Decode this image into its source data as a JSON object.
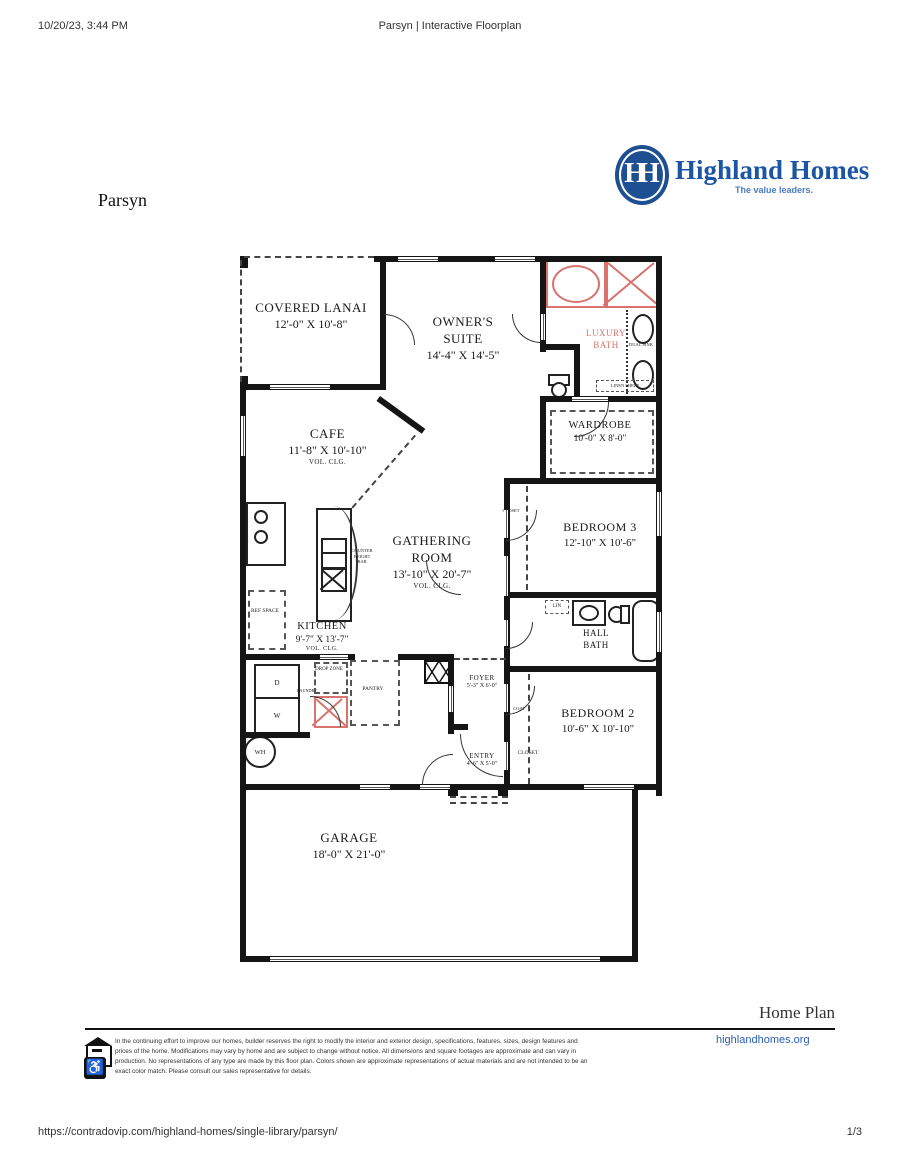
{
  "header": {
    "datetime": "10/20/23, 3:44 PM",
    "title": "Parsyn | Interactive Floorplan"
  },
  "brand": {
    "monogram": "HH",
    "name": "Highland Homes",
    "tagline": "The value leaders.",
    "blue": "#1d4f91",
    "red": "#d9736d"
  },
  "plan": {
    "name": "Parsyn",
    "rooms": {
      "lanai": {
        "name": "COVERED LANAI",
        "dims": "12'-0\" X 10'-8\""
      },
      "suite": {
        "name": "OWNER'S SUITE",
        "dims": "14'-4\" X 14'-5\""
      },
      "luxury_bath section": {
        "name": "LUXURY BATH"
      },
      "luxury_bath": {
        "name": "LUXURY BATH"
      },
      "wardrobe": {
        "name": "WARDROBE",
        "dims": "10'-0\" X 8'-0\""
      },
      "cafe": {
        "name": "CAFE",
        "dims": "11'-8\" X 10'-10\"",
        "note": "VOL. CLG."
      },
      "gathering": {
        "name": "GATHERING ROOM",
        "dims": "13'-10\" X 20'-7\"",
        "note": "VOL. CLG."
      },
      "bedroom3": {
        "name": "BEDROOM 3",
        "dims": "12'-10\" X 10'-6\""
      },
      "kitchen": {
        "name": "KITCHEN",
        "dims": "9'-7\" X 13'-7\"",
        "note": "VOL. CLG."
      },
      "hall_bath": {
        "name": "HALL BATH"
      },
      "foyer": {
        "name": "FOYER",
        "dims": "5'-3\" X 6'-0\""
      },
      "bedroom2": {
        "name": "BEDROOM 2",
        "dims": "10'-6\" X 10'-10\""
      },
      "entry": {
        "name": "ENTRY",
        "dims": "4'-6\" X 5'-0\""
      },
      "garage": {
        "name": "GARAGE",
        "dims": "18'-0\" X 21'-0\""
      }
    },
    "labels": {
      "closet": "CLOSET",
      "coat": "COAT",
      "pantry": "PANTRY",
      "drop_zone": "DROP ZONE",
      "laundry": "LAUNDRY",
      "ref_space": "REF SPACE",
      "counter_bar": "COUNTER HEIGHT BAR",
      "dual_sink": "DUAL SINK",
      "linen_shelf": "LINEN SHELF",
      "lin": "LIN",
      "dryer": "D",
      "washer": "W",
      "water_heater": "WH"
    }
  },
  "bottom": {
    "section_title": "Home Plan",
    "disclaimer": "In the continuing effort to improve our homes, builder reserves the right to modify the interior and exterior design, specifications, features, sizes, design features and prices of the home. Modifications may vary by home and are subject to change without notice. All dimensions and square footages are approximate and can vary in production. No representations of any type are made by this floor plan. Colors shown are approximate representations of actual materials and are not intended to be an exact color match. Please consult our sales representative for details.",
    "link": "highlandhomes.org"
  },
  "footer": {
    "url": "https://contradovip.com/highland-homes/single-library/parsyn/",
    "page": "1/3"
  }
}
